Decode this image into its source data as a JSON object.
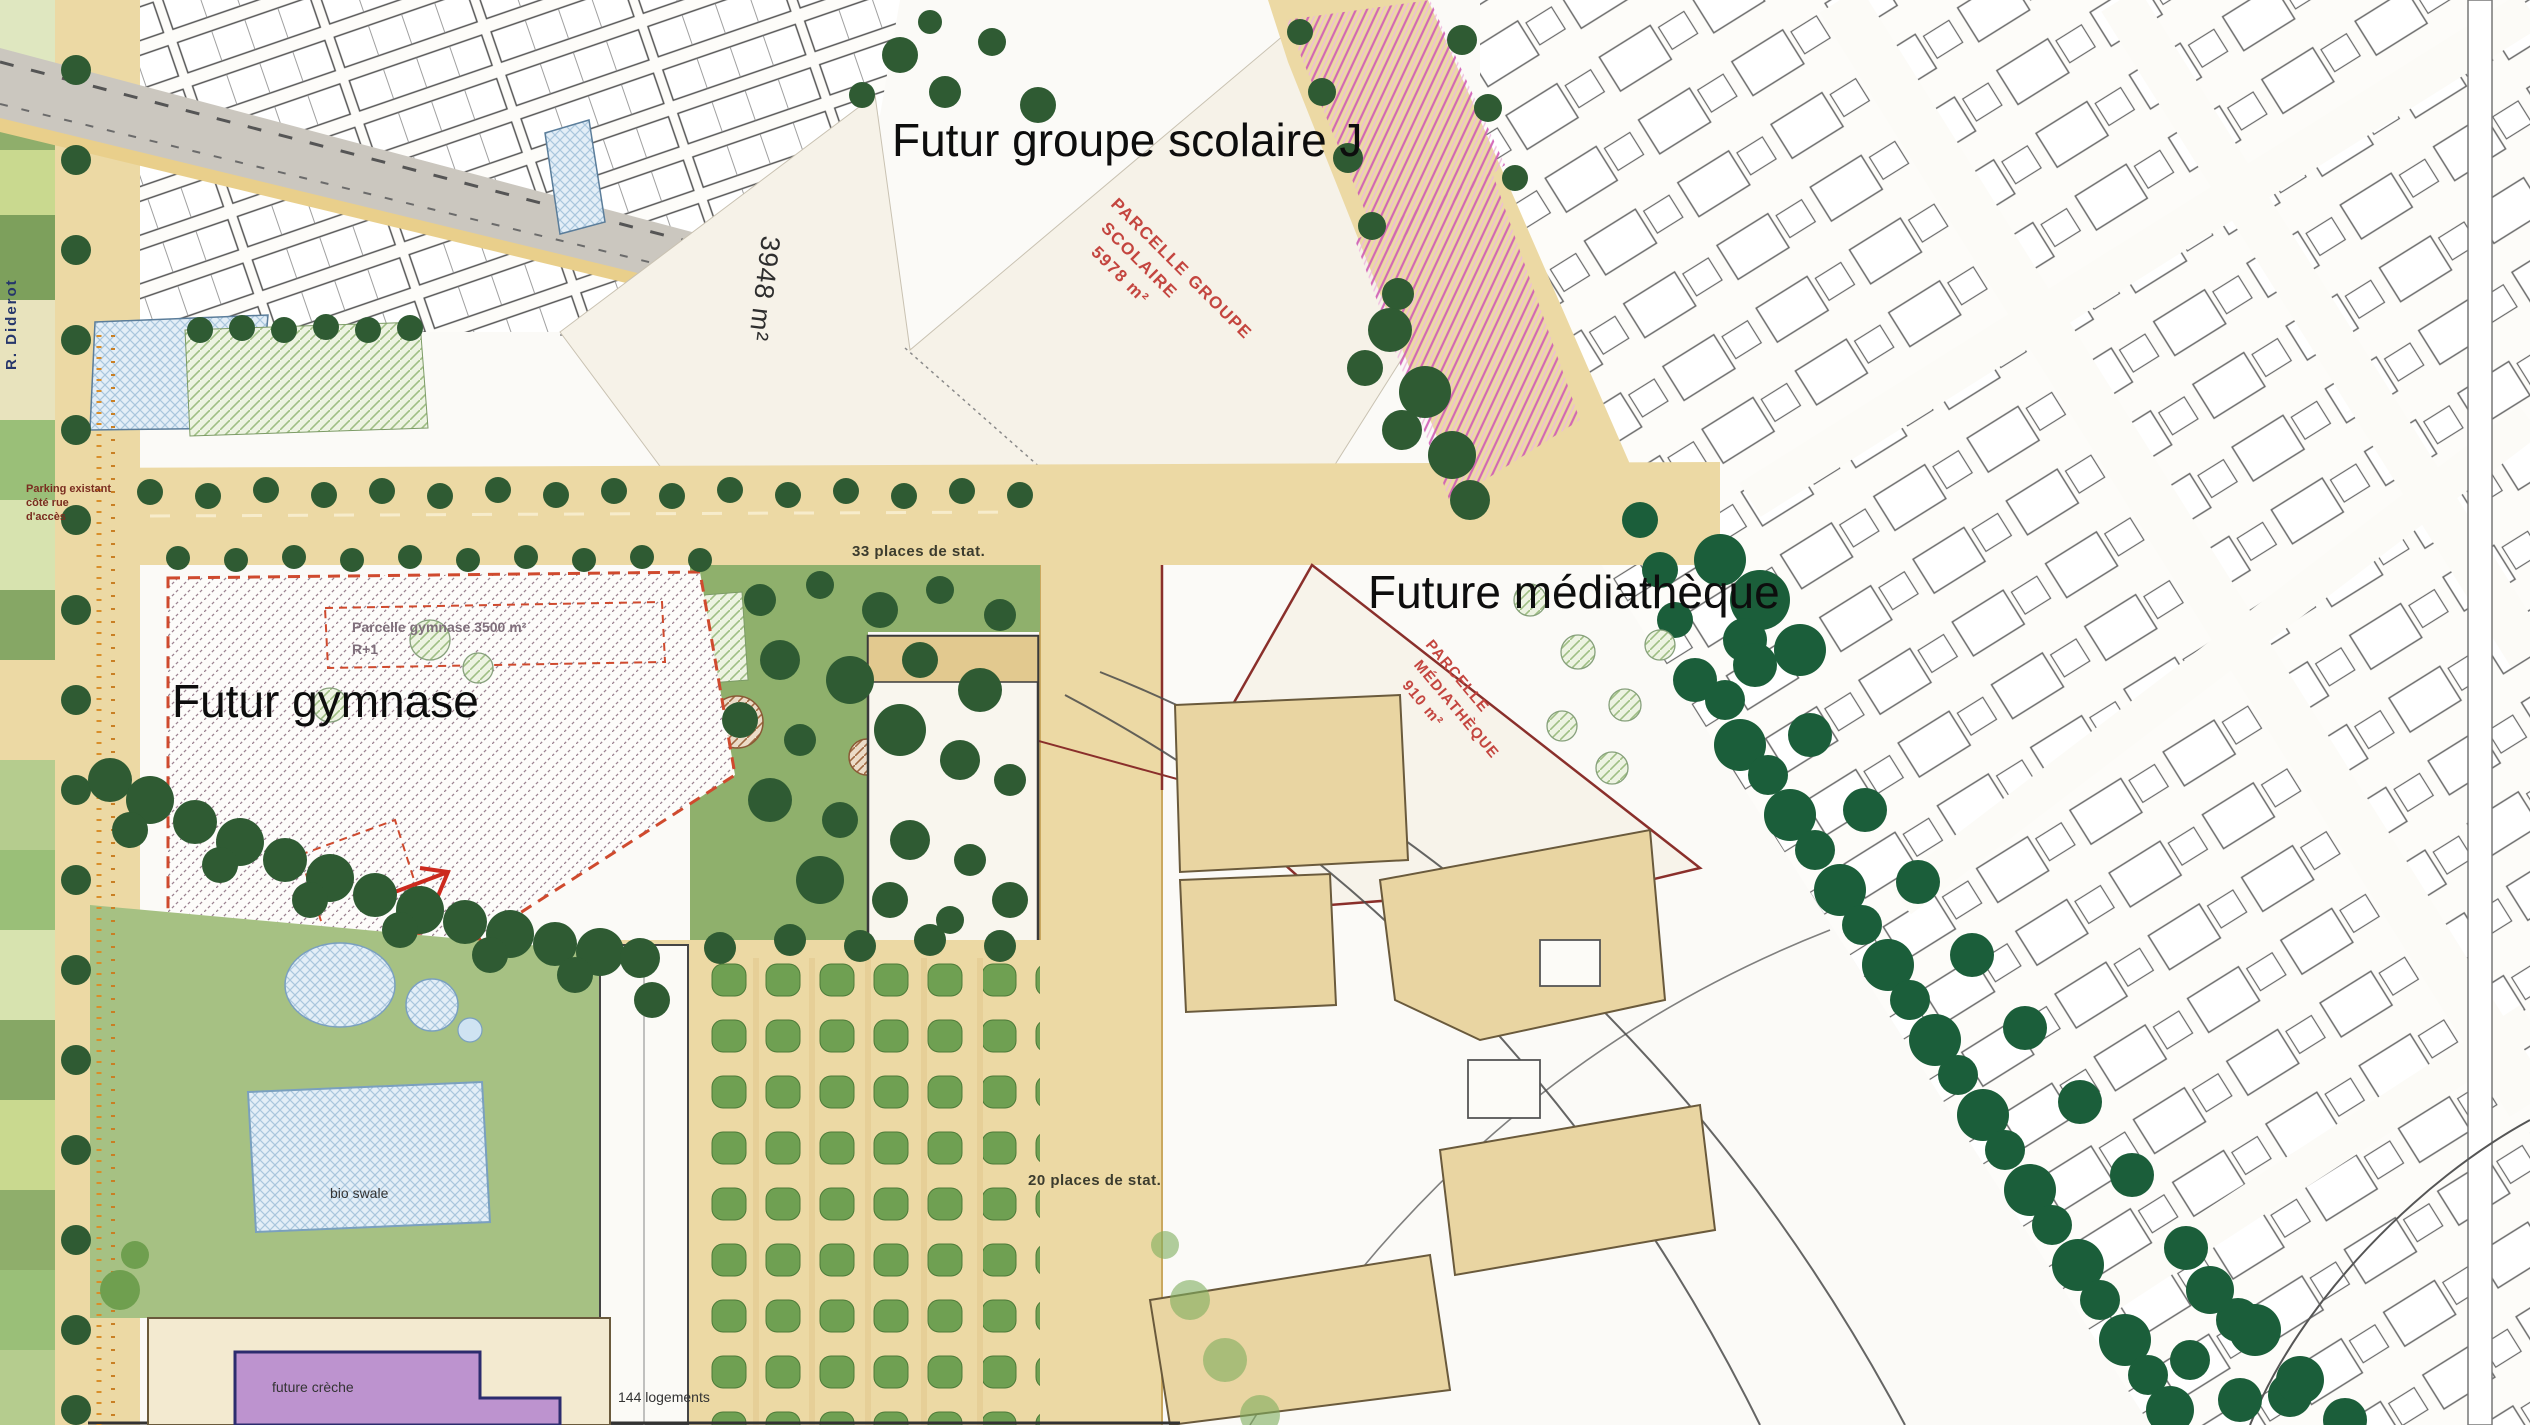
{
  "labels": {
    "school": "Futur groupe scolaire J",
    "mediatheque": "Future médiathèque",
    "gymnase": "Futur gymnase"
  },
  "parcel_notes": {
    "school": [
      "PARCELLE GROUPE",
      "SCOLAIRE",
      "5978 m²"
    ],
    "mediatheque": [
      "PARCELLE",
      "MÉDIATHÈQUE",
      "910 m²"
    ],
    "gymnase_line1": "Parcelle gymnase 3500 m²",
    "gymnase_line2": "R+1"
  },
  "parking": {
    "north": "33 places de stat.",
    "south": "20 places de stat."
  },
  "misc": {
    "plot_area": "3948 m²",
    "housing": "144 logements",
    "creche": "future crèche",
    "pond": "bio swale",
    "street": "R. Diderot",
    "note": [
      "Parking existant",
      "côté rue",
      "d'accès"
    ]
  },
  "colors": {
    "road_tan": "#ecd9a4",
    "road_gray": "#cbc7bf",
    "parcel_cream": "#f6f2e8",
    "tree_dark_green": "#2f5b33",
    "avenue_green": "#1b5e3a",
    "lawn_green": "#8fb06c",
    "water_blue": "#e3eef7",
    "creche_purple": "#bd93cf",
    "hatch_magenta": "#cf5cb5",
    "parcel_red_text": "#c4453f",
    "dashed_red_outline": "#cf4a2e",
    "building_beige": "#e9d5a2"
  }
}
